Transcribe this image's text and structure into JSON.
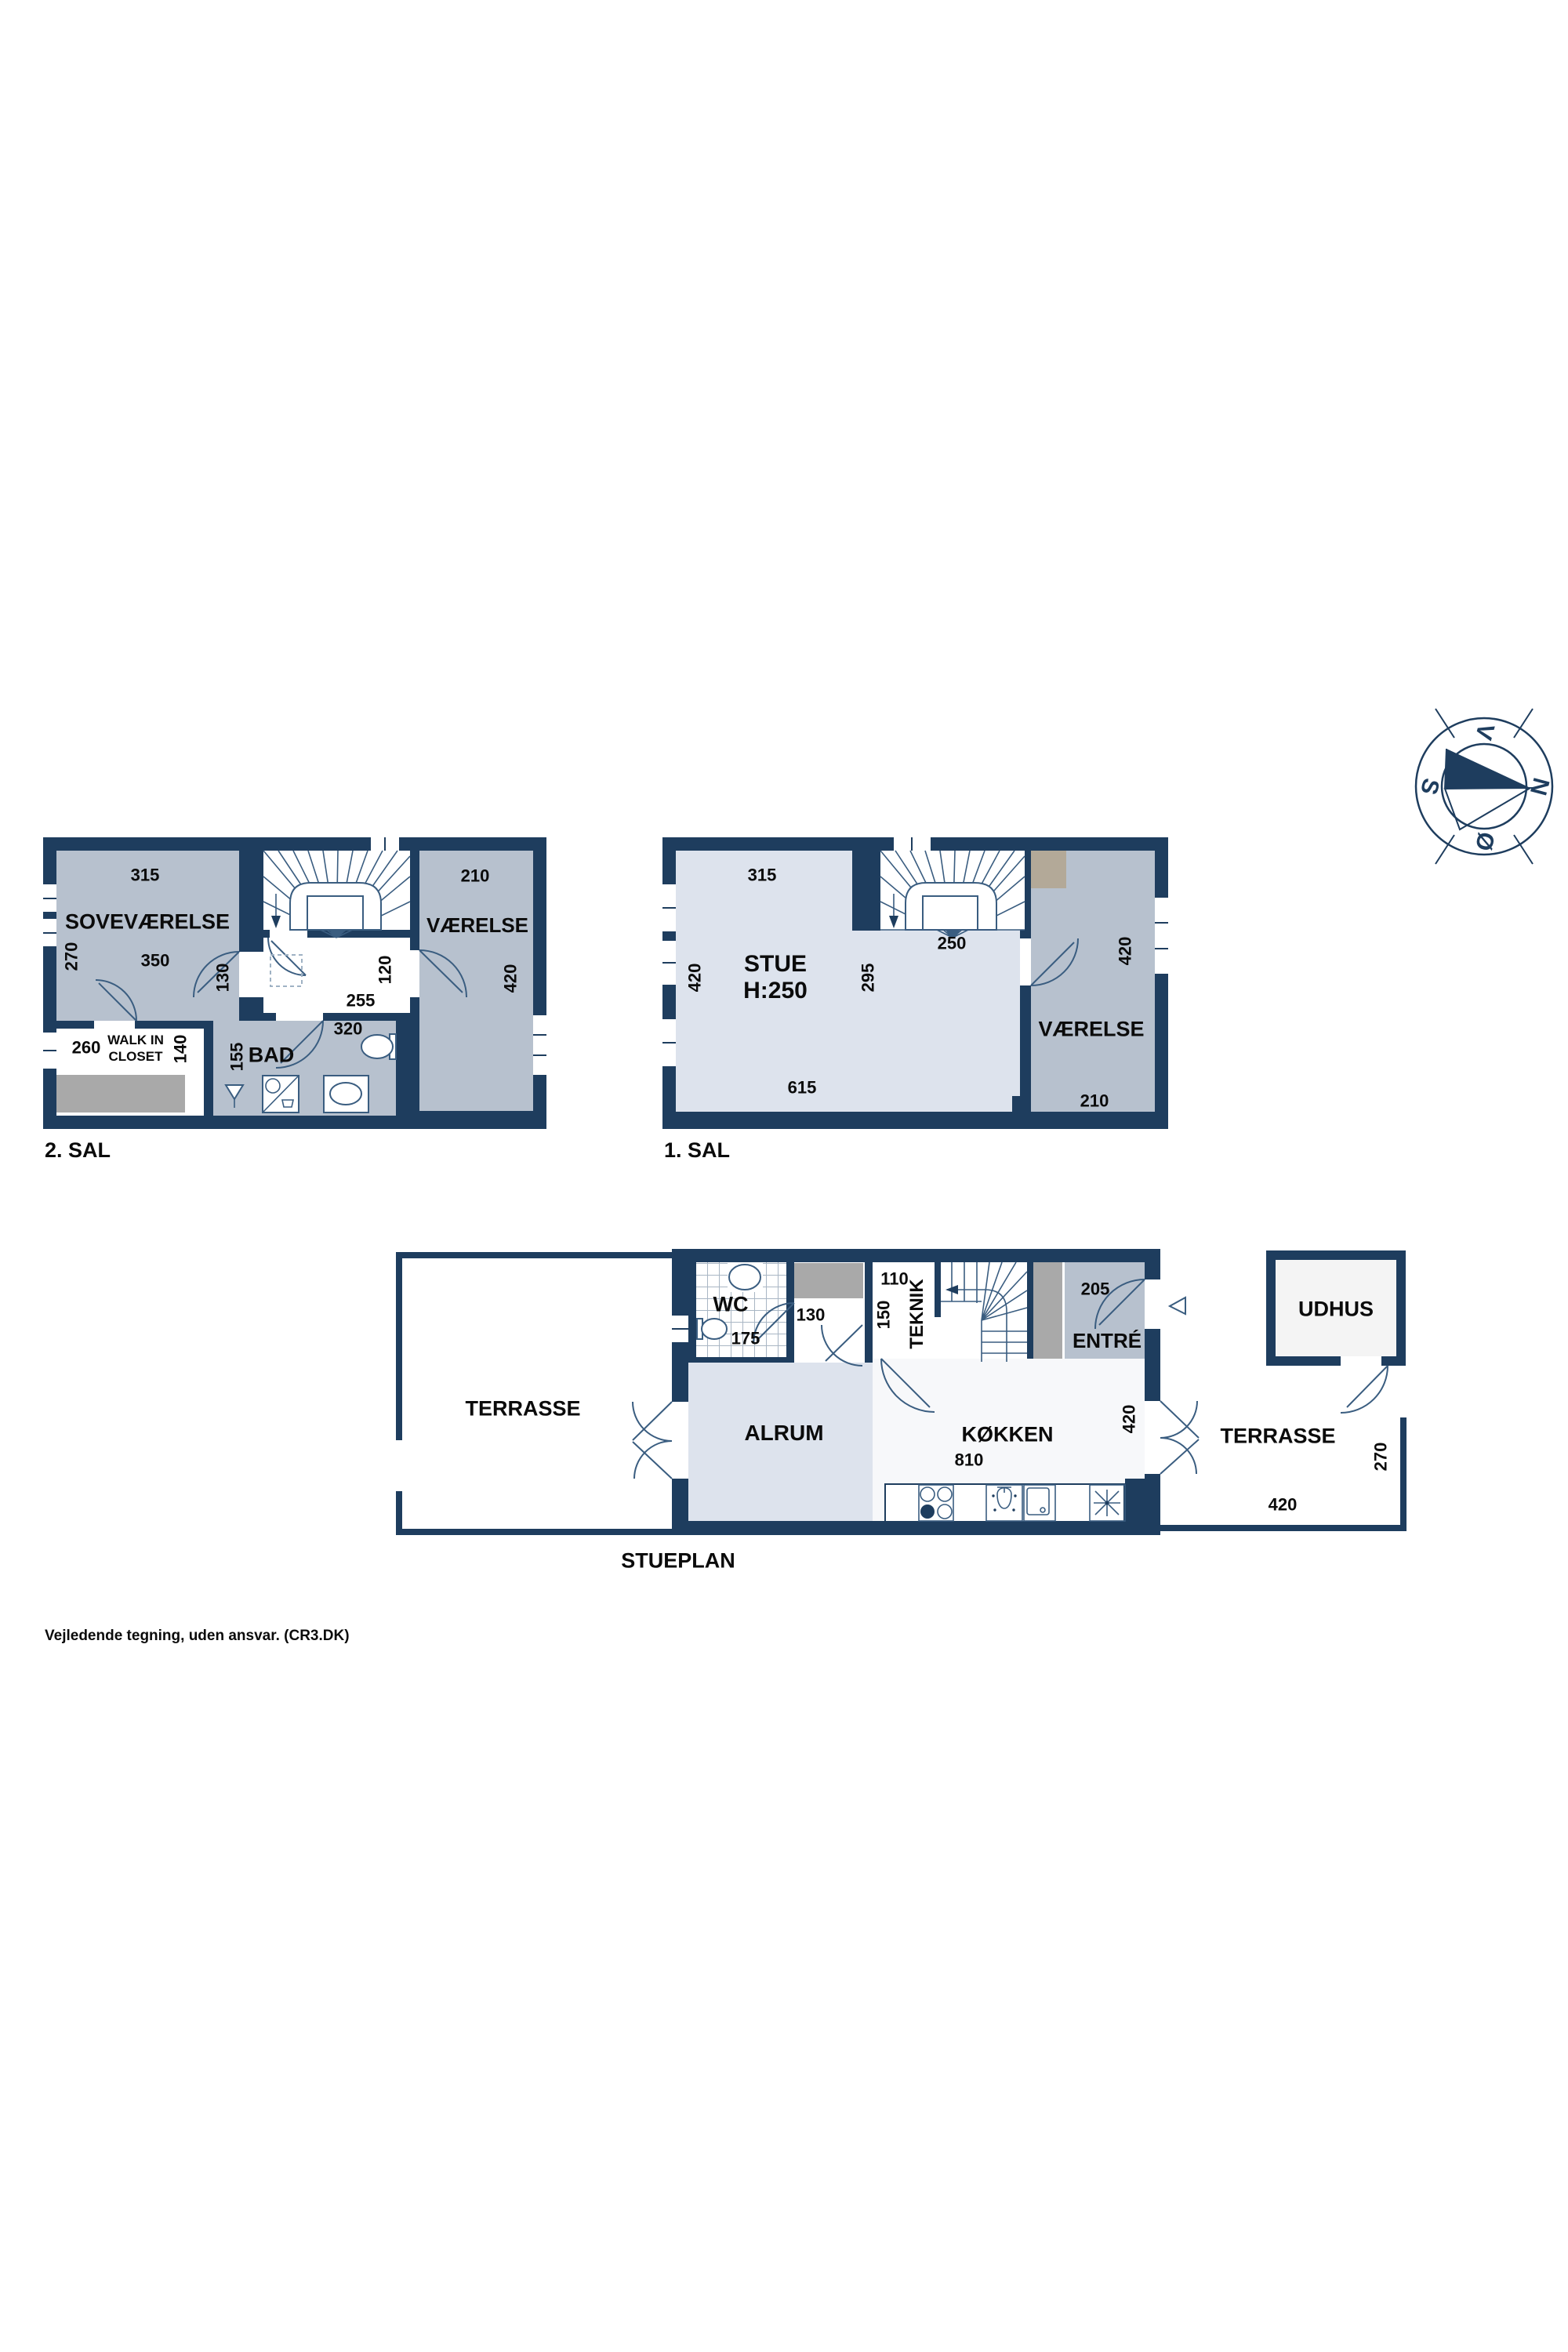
{
  "colors": {
    "wall": "#1e3d5e",
    "room_gray": "#b7c1ce",
    "room_light": "#dde3ed",
    "fixture_gray": "#a9a9a9",
    "chimney": "#b3a998",
    "line": "#3a5d80"
  },
  "compass": {
    "top": "V",
    "right": "N",
    "left": "S",
    "bottom": "Ø"
  },
  "sal2": {
    "label": "2. SAL",
    "sove": {
      "name": "SOVEVÆRELSE",
      "top": "315",
      "left": "270",
      "mid": "350",
      "door": "130"
    },
    "landing": {
      "w": "255",
      "h": "120"
    },
    "vaerelse": {
      "name": "VÆRELSE",
      "top": "210",
      "right": "420"
    },
    "closet": {
      "name1": "WALK IN",
      "name2": "CLOSET",
      "w": "260",
      "h": "140"
    },
    "bad": {
      "name": "BAD",
      "left": "155",
      "top": "320"
    }
  },
  "sal1": {
    "label": "1. SAL",
    "stue": {
      "name": "STUE",
      "height": "H:250",
      "top": "315",
      "left": "420",
      "mid": "295",
      "bottom": "615"
    },
    "stair": {
      "w": "250"
    },
    "vaerelse": {
      "name": "VÆRELSE",
      "right": "420",
      "bottom": "210"
    }
  },
  "stueplan": {
    "label": "STUEPLAN",
    "terrasse_left": "TERRASSE",
    "wc": {
      "name": "WC",
      "w": "175"
    },
    "hall": {
      "w": "130"
    },
    "teknik": {
      "name": "TEKNIK",
      "w": "110",
      "h": "150"
    },
    "entre": {
      "name": "ENTRÉ",
      "w": "205"
    },
    "alrum": {
      "name": "ALRUM"
    },
    "kokken": {
      "name": "KØKKEN",
      "w": "810",
      "h": "420"
    },
    "terrasse_right": {
      "name": "TERRASSE",
      "w": "420",
      "h": "270"
    },
    "udhus": {
      "name": "UDHUS"
    }
  },
  "footer": "Vejledende tegning, uden ansvar. (CR3.DK)"
}
